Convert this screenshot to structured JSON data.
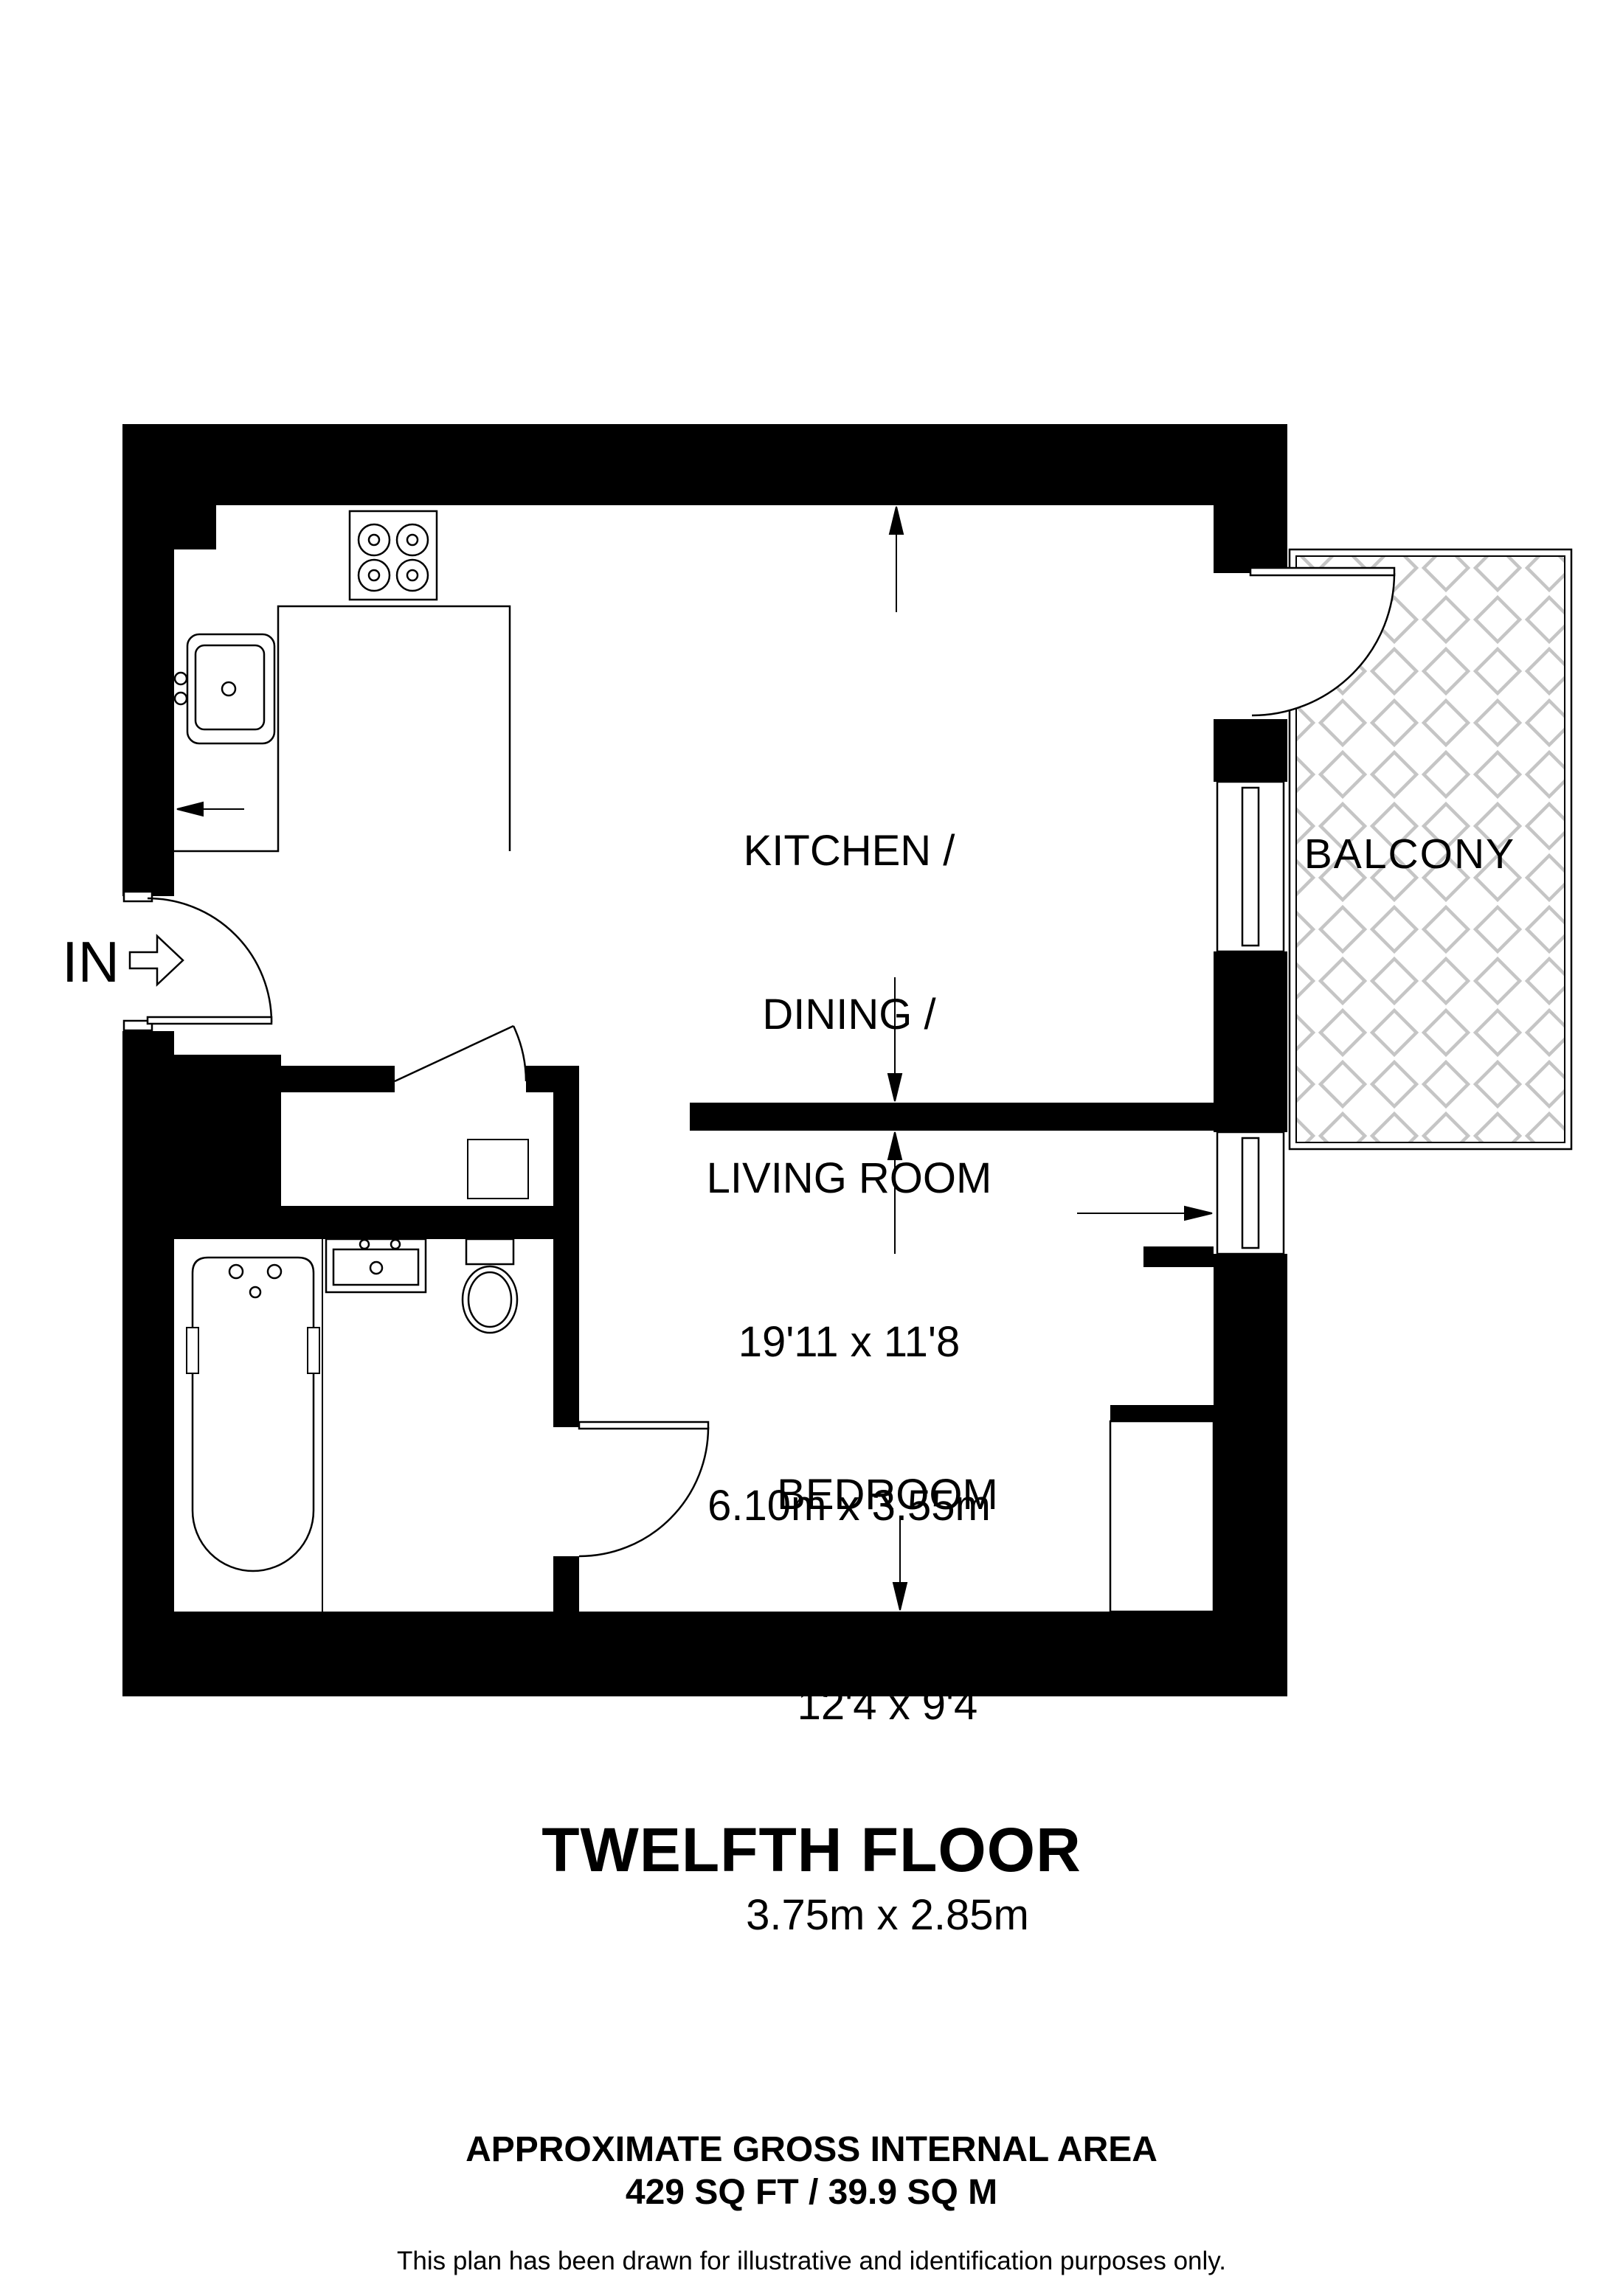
{
  "title": "TWELFTH FLOOR",
  "entrance": {
    "label": "IN"
  },
  "rooms": {
    "kitchen": {
      "name_lines": [
        "KITCHEN /",
        "DINING /",
        "LIVING ROOM"
      ],
      "dims_imperial": "19'11 x 11'8",
      "dims_metric": "6.10m x 3.55m"
    },
    "bedroom": {
      "name": "BEDROOM",
      "dims_imperial": "12'4 x 9'4",
      "dims_metric": "3.75m x 2.85m"
    },
    "balcony": {
      "name": "BALCONY"
    }
  },
  "footer": {
    "area_heading": "APPROXIMATE GROSS INTERNAL AREA",
    "area_value": "429 SQ FT / 39.9 SQ M",
    "disclaimer": "This plan has been drawn for illustrative and identification purposes only."
  },
  "colors": {
    "wall": "#000000",
    "background": "#ffffff",
    "hatch": "#c5c5c5",
    "line": "#000000"
  },
  "icons": {
    "entrance_arrow": "right-arrow-outline",
    "dimension_arrows": "solid-triangle-pointers",
    "fixtures": [
      "hob-4-burners",
      "kitchen-sink",
      "bathtub",
      "basin",
      "toilet"
    ]
  }
}
